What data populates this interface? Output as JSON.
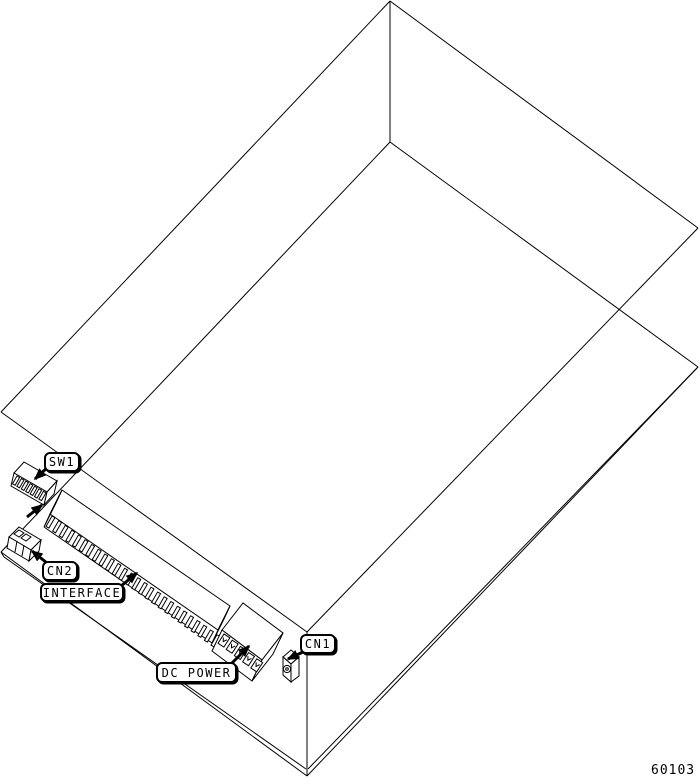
{
  "figure": {
    "drawing_number": "60103",
    "colors": {
      "ink": "#000000",
      "paper": "#ffffff"
    }
  },
  "callouts": [
    {
      "id": "sw1",
      "label": "SW1",
      "component": "dip-switch"
    },
    {
      "id": "cn2",
      "label": "CN2",
      "component": "small-connector"
    },
    {
      "id": "interface",
      "label": "INTERFACE",
      "component": "card-edge-connector"
    },
    {
      "id": "dc-power",
      "label": "DC POWER",
      "component": "screw-terminal-block"
    },
    {
      "id": "cn1",
      "label": "CN1",
      "component": "power-jack"
    }
  ]
}
